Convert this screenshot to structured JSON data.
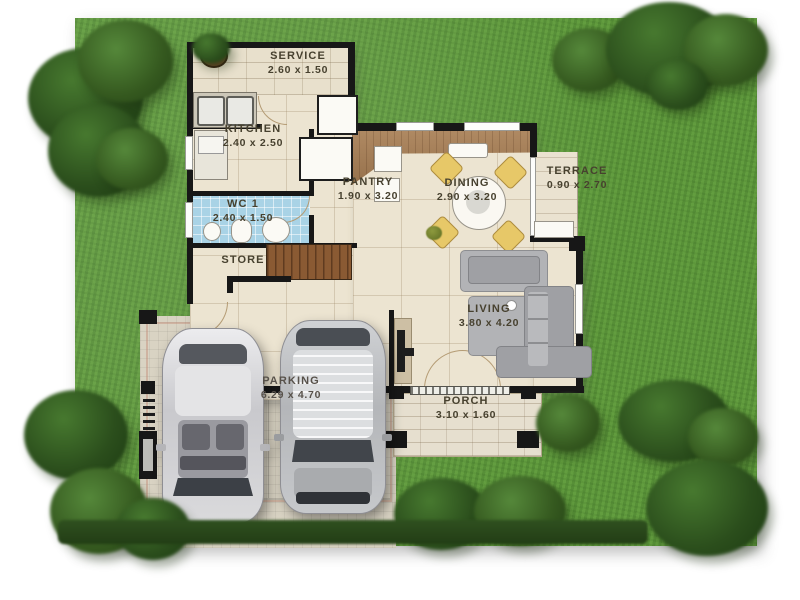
{
  "type": "house-floor-plan",
  "rooms": {
    "service": {
      "name": "SERVICE",
      "dims": "2.60 x 1.50"
    },
    "kitchen": {
      "name": "KITCHEN",
      "dims": "2.40 x 2.50"
    },
    "pantry": {
      "name": "PANTRY",
      "dims": "1.90 x 3.20"
    },
    "dining": {
      "name": "DINING",
      "dims": "2.90 x 3.20"
    },
    "terrace": {
      "name": "TERRACE",
      "dims": "0.90 x 2.70"
    },
    "wc1": {
      "name": "WC 1",
      "dims": "2.40 x 1.50"
    },
    "store": {
      "name": "STORE",
      "dims": ""
    },
    "living": {
      "name": "LIVING",
      "dims": "3.80 x 4.20"
    },
    "parking": {
      "name": "PARKING",
      "dims": "6.29 x 4.70"
    },
    "porch": {
      "name": "PORCH",
      "dims": "3.10 x 1.60"
    }
  },
  "colors": {
    "lawn": "#5f9a3d",
    "tree_dark": "#2b4e1c",
    "floor_cream": "#ece4d1",
    "wall_black": "#171717",
    "wc_tile_blue": "#a9d3e6",
    "wood_brown": "#a07a52",
    "paving_gray": "#d9d3c3",
    "car_left_silver": "#d9d9db",
    "car_right_gray": "#c2c4c7",
    "label_text": "#47412f"
  },
  "objects": {
    "cars": [
      "silver-car-top-view",
      "gray-suv-top-view"
    ],
    "furniture": [
      "kitchen-sink-counter",
      "refrigerator-cabinet",
      "pantry-shelves",
      "dining-table-set",
      "staircase",
      "wc-fixtures",
      "tv-cabinet",
      "sofa-set",
      "terrace-bench",
      "potted-plant"
    ]
  }
}
